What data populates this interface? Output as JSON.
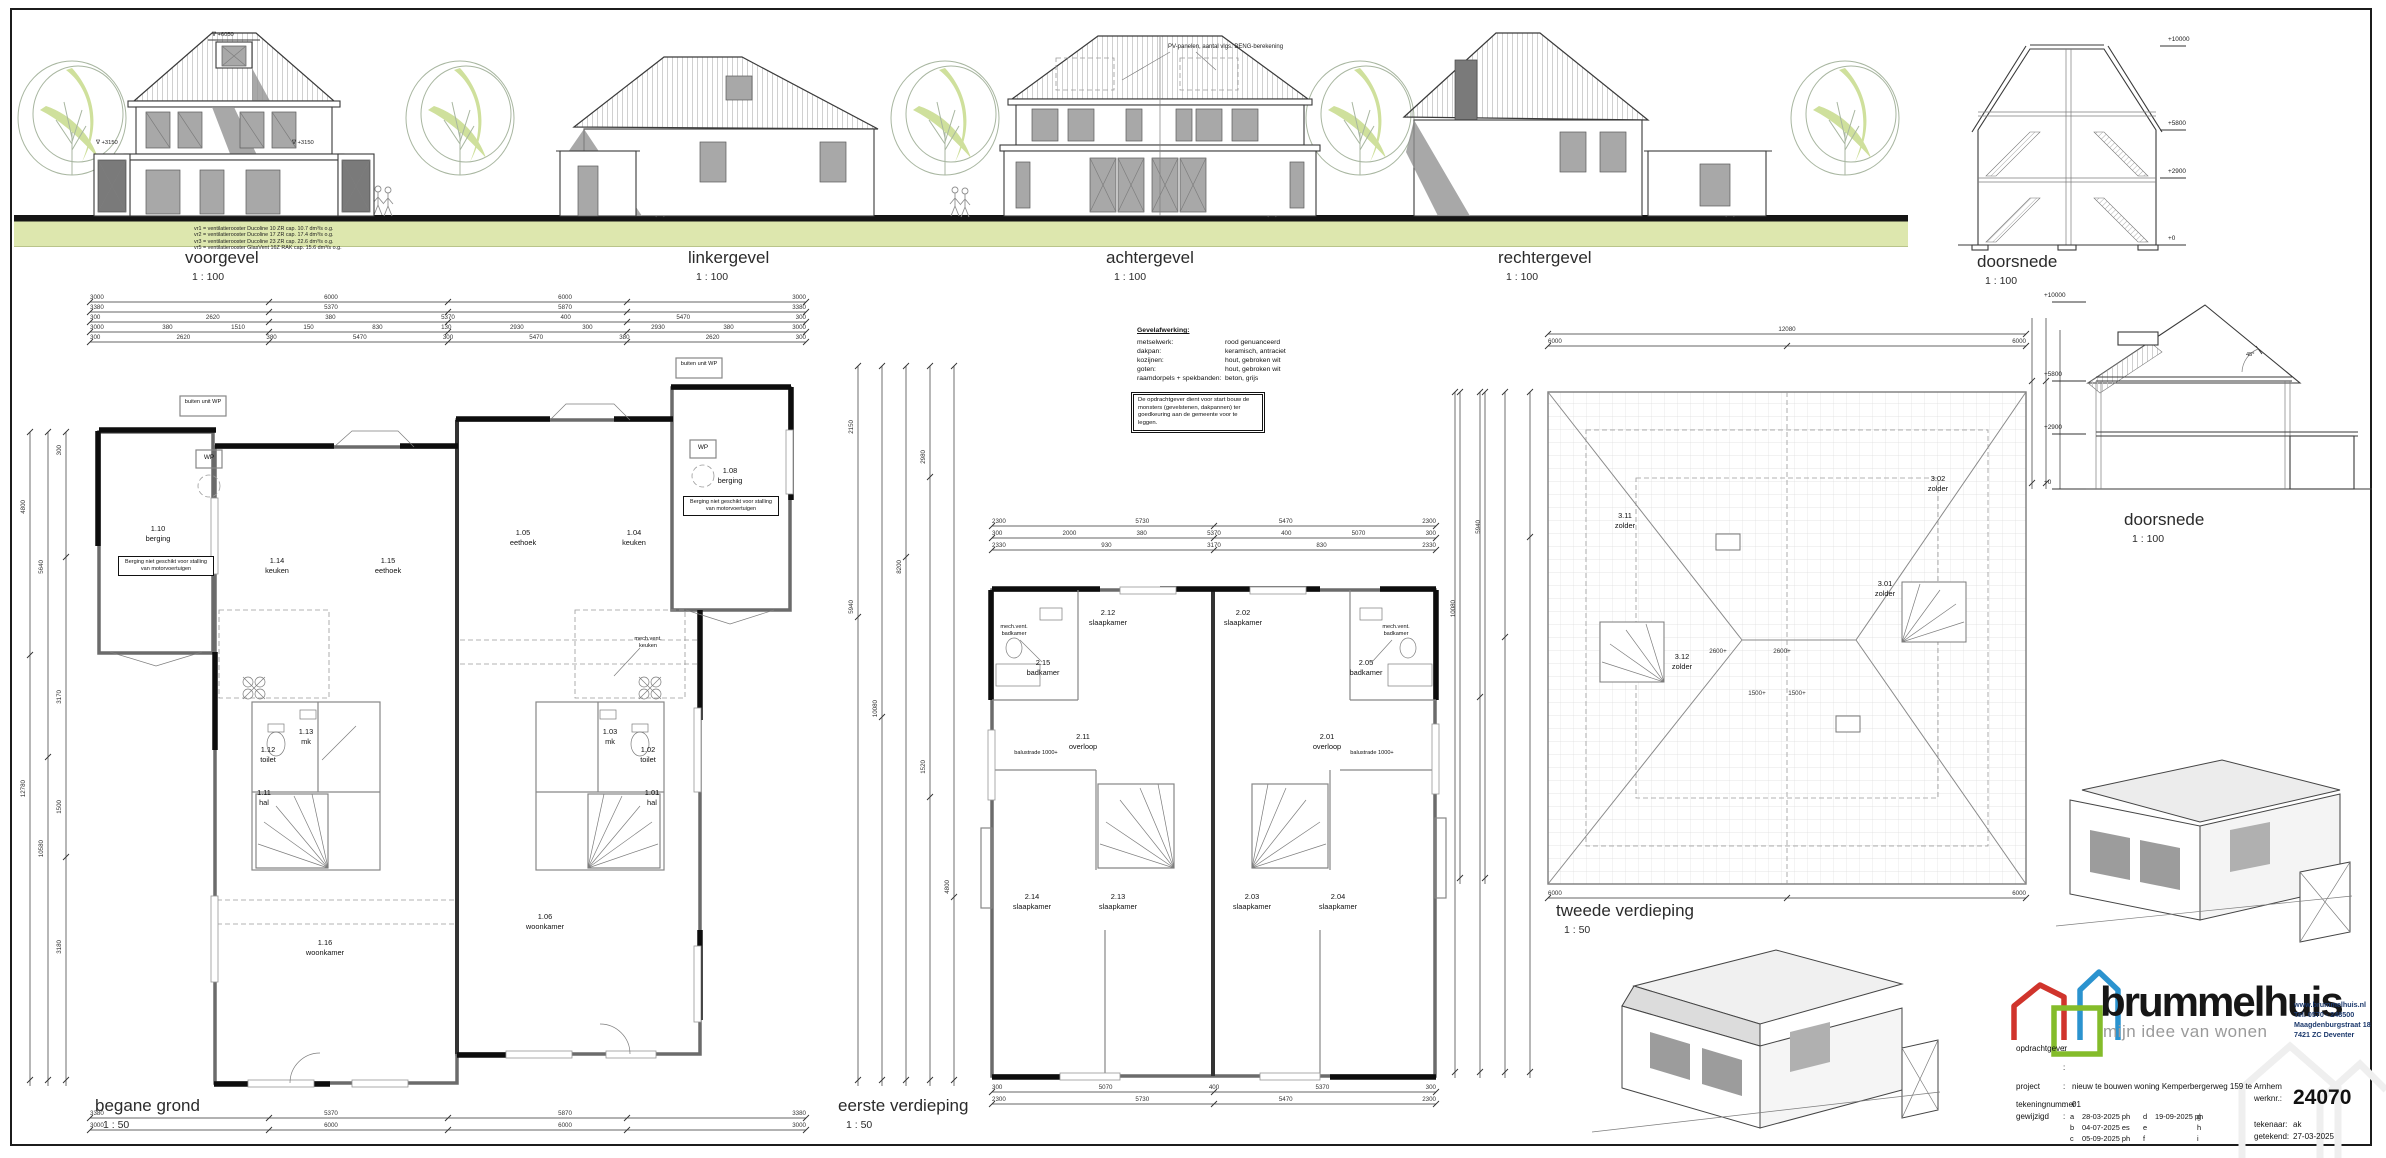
{
  "elevations": [
    {
      "title": "voorgevel",
      "scale": "1 : 100"
    },
    {
      "title": "linkergevel",
      "scale": "1 : 100"
    },
    {
      "title": "achtergevel",
      "scale": "1 : 100"
    },
    {
      "title": "rechtergevel",
      "scale": "1 : 100"
    }
  ],
  "sections": {
    "top": {
      "title": "doorsnede",
      "scale": "1 : 100",
      "levels": [
        "+10000",
        "+5800",
        "+2900",
        "+0"
      ]
    },
    "mid": {
      "title": "doorsnede",
      "scale": "1 : 100",
      "levels": [
        "+10000",
        "+5800",
        "+2900",
        "+0"
      ],
      "roof_angle": "45°"
    }
  },
  "vent_legend": [
    "vr1 = ventilatierooster Ducoline 10 ZR cap. 10.7 dm³/s o.g.",
    "vr2 = ventilatierooster Ducoline 17 ZR cap. 17.4 dm³/s o.g.",
    "vr3 = ventilatierooster Ducoline 23 ZR cap. 22.6 dm³/s o.g.",
    "vr5 = ventilatierooster GlasVent 16Z RAK cap. 15.6 dm³/s o.g."
  ],
  "pv_note": "PV-panelen, aantal vlgs. BENG-berekening",
  "voorgevel_levels": {
    "dormer": "∇ +6050",
    "left": "∇ +3150",
    "right": "∇ +3150"
  },
  "materials": {
    "header": "Gevelafwerking:",
    "rows": [
      {
        "item": "metselwerk:",
        "value": "rood genuanceerd"
      },
      {
        "item": "d​akpan:",
        "value": "keramisch, antraciet"
      },
      {
        "item": "kozijnen:",
        "value": "hout, gebroken wit"
      },
      {
        "item": "goten:",
        "value": "hout, gebroken wit"
      },
      {
        "item": "raamdorpels + spekbanden:",
        "value": "beton, grijs"
      }
    ]
  },
  "approval_note": "De opdrachtgever dient voor start bouw de monsters (gevelstenen, dakpannen) ter goedkeuring aan de gemeente voor te leggen.",
  "plans": {
    "bg": {
      "title": "begane grond",
      "scale": "1 : 50",
      "rooms": [
        {
          "id": "1.10",
          "name": "berging"
        },
        {
          "id": "1.14",
          "name": "keuken"
        },
        {
          "id": "1.15",
          "name": "eethoek"
        },
        {
          "id": "1.16",
          "name": "woonkamer"
        },
        {
          "id": "1.12",
          "name": "toilet"
        },
        {
          "id": "1.13",
          "name": "mk"
        },
        {
          "id": "1.11",
          "name": "hal"
        },
        {
          "id": "1.08",
          "name": "berging"
        },
        {
          "id": "1.04",
          "name": "keuken"
        },
        {
          "id": "1.05",
          "name": "eethoek"
        },
        {
          "id": "1.06",
          "name": "woonkamer"
        },
        {
          "id": "1.02",
          "name": "toilet"
        },
        {
          "id": "1.03",
          "name": "mk"
        },
        {
          "id": "1.01",
          "name": "hal"
        }
      ],
      "wp": "WP",
      "buiten_unit": "buiten unit WP",
      "berging_note": "Berging niet geschikt voor stalling van motorvoertuigen",
      "mech_vent": "mech.vent. keuken",
      "dims_top": [
        [
          "3000",
          "6000",
          "6000",
          "3000"
        ],
        [
          "3380",
          "5370",
          "5870",
          "3380"
        ],
        [
          "300",
          "2620",
          "380",
          "5370",
          "400",
          "5470",
          "300"
        ],
        [
          "3000",
          "380",
          "1510",
          "150",
          "830",
          "130",
          "2930",
          "300",
          "2930",
          "380",
          "3000"
        ],
        [
          "300",
          "2620",
          "380",
          "5470",
          "300",
          "5470",
          "380",
          "2620",
          "300"
        ]
      ],
      "dims_bottom": [
        [
          "3380",
          "5370",
          "5870",
          "3380"
        ],
        [
          "3000",
          "6000",
          "6000",
          "3000"
        ]
      ],
      "dims_left": [
        "4800",
        "12780",
        "5640",
        "10580",
        "300",
        "3170",
        "1500",
        "3180"
      ],
      "dims_mid": [
        "2150",
        "5940",
        "10080",
        "8200",
        "2980",
        "1520",
        "4800"
      ]
    },
    "ev": {
      "title": "eerste verdieping",
      "scale": "1 : 50",
      "rooms": [
        {
          "id": "2.05",
          "name": "badkamer"
        },
        {
          "id": "2.01",
          "name": "overloop"
        },
        {
          "id": "2.02",
          "name": "slaapkamer"
        },
        {
          "id": "2.03",
          "name": "slaapkamer"
        },
        {
          "id": "2.04",
          "name": "slaapkamer"
        },
        {
          "id": "2.15",
          "name": "badkamer"
        },
        {
          "id": "2.11",
          "name": "overloop"
        },
        {
          "id": "2.12",
          "name": "slaapkamer"
        },
        {
          "id": "2.13",
          "name": "slaapkamer"
        },
        {
          "id": "2.14",
          "name": "slaapkamer"
        }
      ],
      "balustrade": "balustrade 1000+",
      "mech_vent": "mech.vent. badkamer",
      "dims_top": [
        [
          "2300",
          "5730",
          "5470",
          "2300"
        ],
        [
          "300",
          "2000",
          "380",
          "5370",
          "400",
          "5070",
          "300"
        ],
        [
          "2330",
          "930",
          "3170",
          "830",
          "2330"
        ]
      ],
      "dims_bottom": [
        [
          "300",
          "5070",
          "400",
          "5370",
          "300"
        ],
        [
          "2300",
          "5730",
          "5470",
          "2300"
        ]
      ]
    },
    "tv": {
      "title": "tweede verdieping",
      "scale": "1 : 50",
      "rooms": [
        {
          "id": "3.12",
          "name": "zolder"
        },
        {
          "id": "3.11",
          "name": "zolder"
        },
        {
          "id": "3.01",
          "name": "zolder"
        },
        {
          "id": "3.02",
          "name": "zolder"
        }
      ],
      "height_marks": [
        "2600+",
        "2600+",
        "1500+",
        "1500+"
      ],
      "dims_top": [
        [
          "12080"
        ],
        [
          "6000",
          "6000"
        ]
      ],
      "dims_bottom": [
        [
          "6000",
          "6000"
        ]
      ],
      "dims_left": [
        "10080",
        "5940"
      ]
    }
  },
  "titleblock": {
    "brand": "brummelhuis",
    "tagline": "mijn idee van wonen",
    "contact": [
      "www.brummelhuis.nl",
      "Tel. 0570 - 248500",
      "Maagdenburgstraat 18",
      "7421 ZC Deventer"
    ],
    "colon": ":",
    "fields": {
      "opdrachtgever_label": "opdrachtgever",
      "project_label": "project",
      "project_value": "nieuw te bouwen woning Kemperbergerweg 159 te Arnhem",
      "tekeningnummer_label": "tekeningnummer",
      "tekeningnummer_value": "01",
      "gewijzigd_label": "gewijzigd",
      "werknr_label": "werknr.:",
      "werknr_value": "24070",
      "tekenaar_label": "tekenaar:",
      "tekenaar_value": "ak",
      "getekend_label": "getekend:",
      "getekend_value": "27-03-2025"
    },
    "revisions": [
      {
        "k": "a",
        "v": "28-03-2025 ph",
        "k2": "d",
        "v2": "19-09-2025 ph",
        "k3": "g",
        "v3": ""
      },
      {
        "k": "b",
        "v": "04-07-2025 es",
        "k2": "e",
        "v2": "",
        "k3": "h",
        "v3": ""
      },
      {
        "k": "c",
        "v": "05-09-2025 ph",
        "k2": "f",
        "v2": "",
        "k3": "i",
        "v3": ""
      }
    ]
  }
}
